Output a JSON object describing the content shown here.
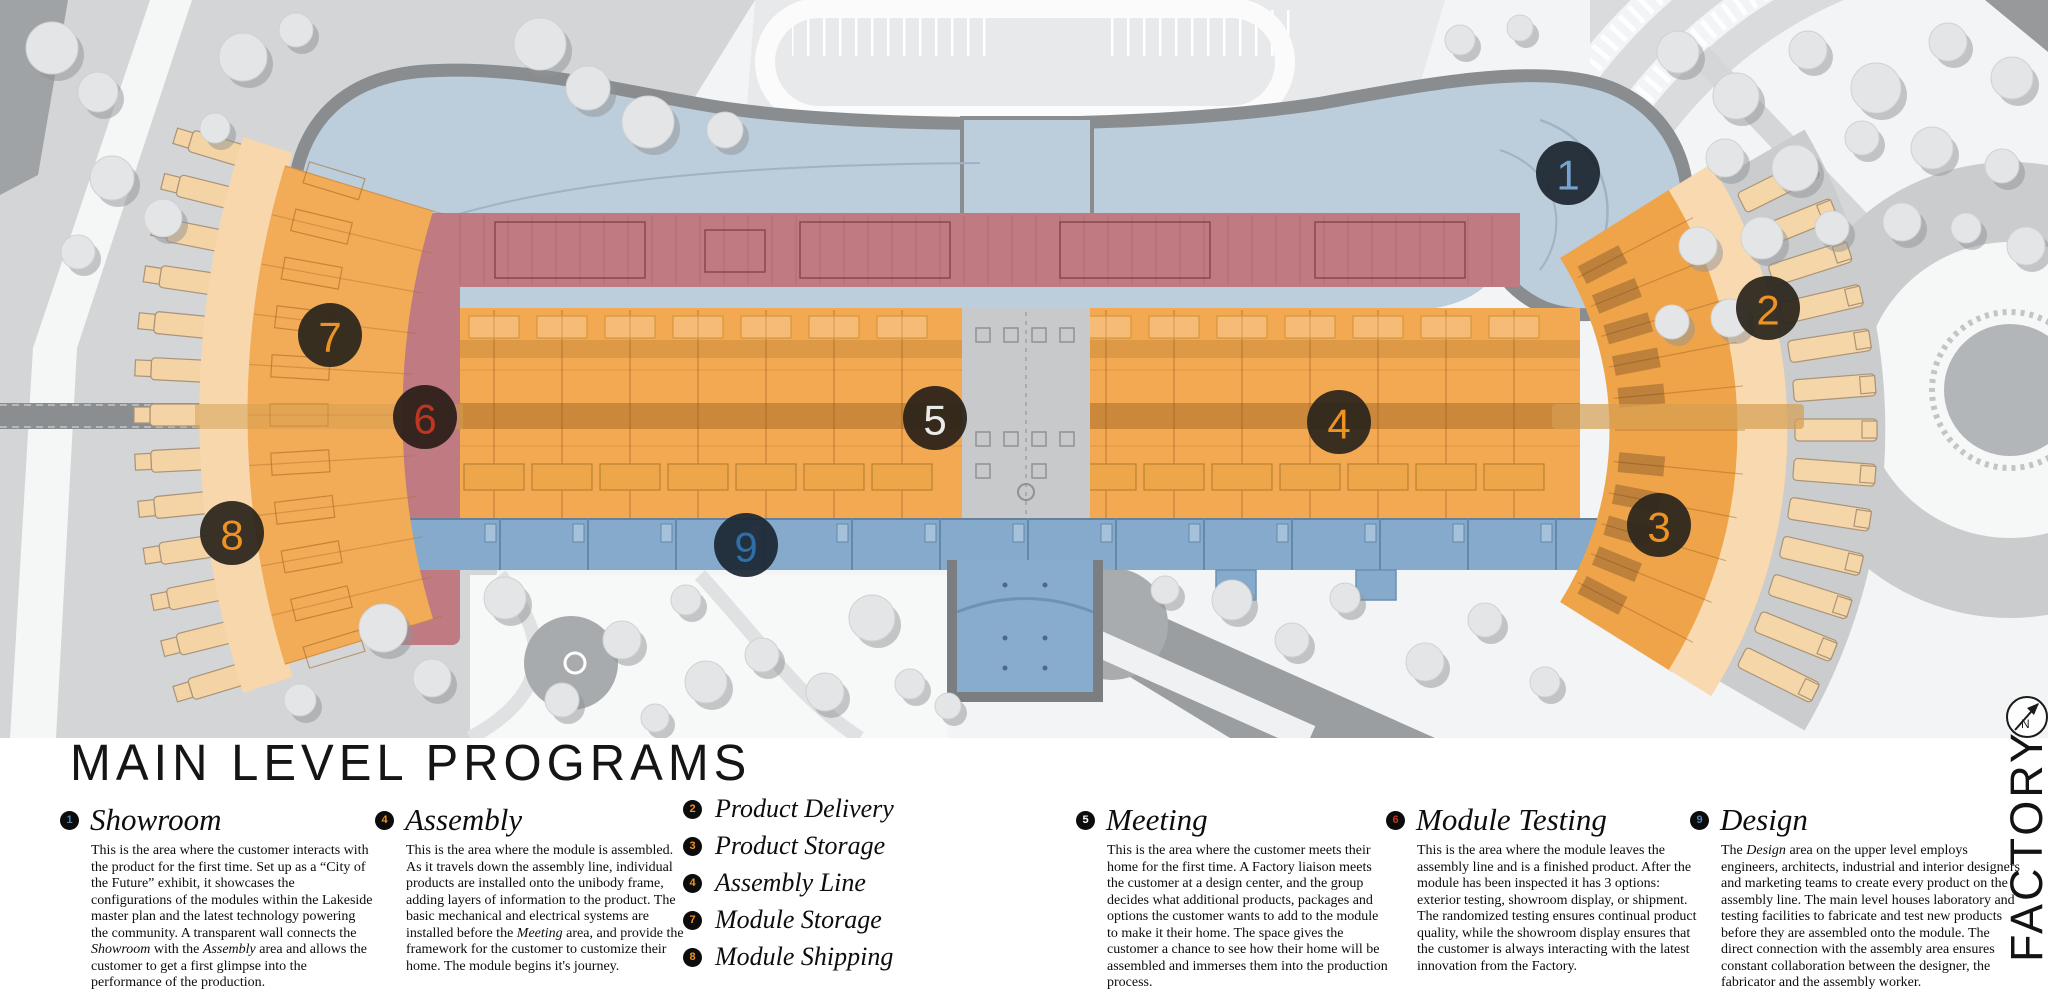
{
  "title": "MAIN LEVEL PROGRAMS",
  "vertical_label": "FACTORY",
  "compass": {
    "n": "N"
  },
  "colors": {
    "showroom_blue": "#bccddc",
    "assembly_orange": "#f3a952",
    "red_band": "#bf7b81",
    "service_blue": "#85aacb",
    "marker_orange": "#ee9323",
    "marker_blue": "#5f93c4",
    "marker_red": "#bf3522"
  },
  "map": {
    "markers": [
      {
        "n": "1",
        "x": 1568,
        "y": 173,
        "bg": "#1d2630",
        "fg": "#76a3cf"
      },
      {
        "n": "2",
        "x": 1768,
        "y": 308,
        "bg": "#2a251c",
        "fg": "#ee9323"
      },
      {
        "n": "3",
        "x": 1659,
        "y": 525,
        "bg": "#2a251c",
        "fg": "#ee9323"
      },
      {
        "n": "4",
        "x": 1339,
        "y": 422,
        "bg": "#2a251c",
        "fg": "#ee9323"
      },
      {
        "n": "5",
        "x": 935,
        "y": 418,
        "bg": "#29211a",
        "fg": "#e9eaea"
      },
      {
        "n": "6",
        "x": 425,
        "y": 417,
        "bg": "#2b1d1a",
        "fg": "#bf3522"
      },
      {
        "n": "7",
        "x": 330,
        "y": 335,
        "bg": "#2a251c",
        "fg": "#ee9323"
      },
      {
        "n": "8",
        "x": 232,
        "y": 533,
        "bg": "#2a251c",
        "fg": "#ee9323"
      },
      {
        "n": "9",
        "x": 746,
        "y": 545,
        "bg": "#1c2733",
        "fg": "#2e6ea9"
      }
    ]
  },
  "legend": {
    "sections": [
      {
        "num": "1",
        "num_color": "#4f81b3",
        "heading": "Showroom",
        "body": "This is the area where the customer interacts with the product for the first time. Set up as a “City of the Future” exhibit, it showcases the configurations of the modules within the Lakeside master plan and the latest technology powering the community. A transparent wall connects the *Showroom* with the *Assembly* area and allows the customer to get a first glimpse into the performance of the production."
      },
      {
        "num": "4",
        "num_color": "#ee9323",
        "heading": "Assembly",
        "body": "This is the area where the module is assembled. As it travels down the assembly line, individual products are installed onto the unibody frame, adding layers of information to the product. The basic mechanical and electrical systems are installed before the *Meeting* area, and provide the framework for the customer to customize their home. The module begins it's journey."
      },
      {
        "items": [
          {
            "num": "2",
            "num_color": "#ee9323",
            "label": "Product Delivery"
          },
          {
            "num": "3",
            "num_color": "#ee9323",
            "label": "Product Storage"
          },
          {
            "num": "4",
            "num_color": "#ee9323",
            "label": "Assembly Line"
          },
          {
            "num": "7",
            "num_color": "#ee9323",
            "label": "Module Storage"
          },
          {
            "num": "8",
            "num_color": "#ee9323",
            "label": "Module Shipping"
          }
        ]
      },
      {
        "num": "5",
        "num_color": "#ffffff",
        "heading": "Meeting",
        "body": "This is the area where the customer meets their home for the first time. A Factory liaison meets the customer at a design center, and the group decides what additional products, packages and options the customer wants to add to the module to make it their home. The space gives the customer a chance to see how their home will be assembled and immerses them into the production process."
      },
      {
        "num": "6",
        "num_color": "#c03524",
        "heading": "Module Testing",
        "body": "This is the area where the module leaves the assembly line and is a finished product. After the module has been inspected it has 3 options: exterior testing, showroom display, or shipment. The randomized testing ensures continual product quality, while the showroom display ensures that the customer is always interacting with the latest innovation from the Factory."
      },
      {
        "num": "9",
        "num_color": "#4f81b3",
        "heading": "Design",
        "body": "The *Design* area on the upper level employs engineers, architects, industrial and interior designers and marketing teams to create every product on the assembly line. The main level houses laboratory and testing facilities to fabricate and test new products before they are assembled onto the module. The direct connection with the assembly area ensures constant collaboration between the designer, the fabricator and the assembly worker."
      }
    ]
  }
}
